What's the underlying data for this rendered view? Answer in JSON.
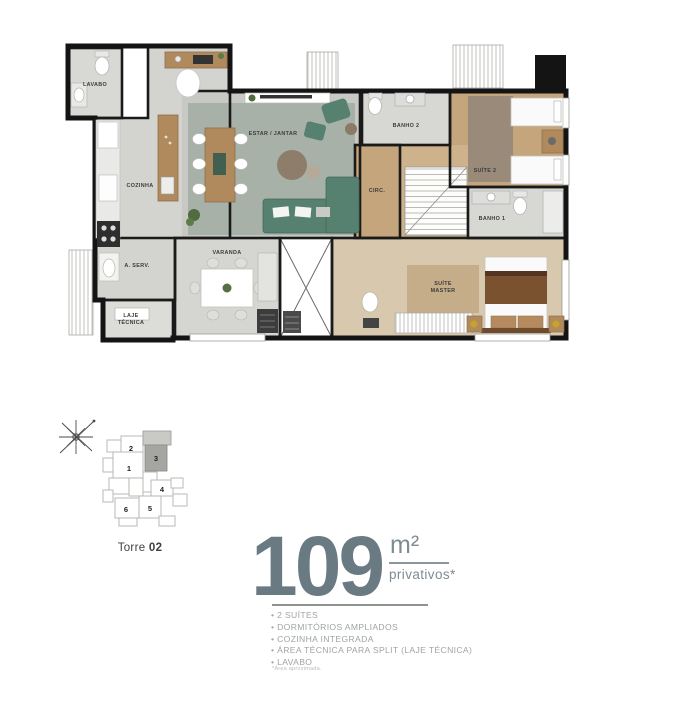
{
  "floor_plan": {
    "rooms": {
      "lavabo": "LAVABO",
      "cozinha": "COZINHA",
      "estar_jantar": "ESTAR / JANTAR",
      "varanda": "VARANDA",
      "area_servico": "A. SERV.",
      "laje_line1": "LAJE",
      "laje_line2": "TÉCNICA",
      "banho2": "BANHO 2",
      "suite2": "SUÍTE 2",
      "circ": "CIRC.",
      "banho1": "BANHO 1",
      "suite_master_line1": "SUÍTE",
      "suite_master_line2": "MASTER"
    },
    "colors": {
      "wall": "#1a1a1a",
      "tile_floor": "#d6d6d2",
      "wood_floor": "#c4a57c",
      "living_rug": "#a7b1a8",
      "sofa": "#56806f",
      "master_wood": "#d8c9ae"
    }
  },
  "key_plan": {
    "tower_label": "Torre",
    "tower_number": "02",
    "units": [
      "1",
      "2",
      "3",
      "4",
      "5",
      "6"
    ],
    "highlighted_unit": "3",
    "highlight_color": "#a5a5a1"
  },
  "info": {
    "area_value": "109",
    "area_unit": "m²",
    "area_qualifier": "privativos*",
    "features": [
      "2 SUÍTES",
      "DORMITÓRIOS AMPLIADOS",
      "COZINHA INTEGRADA",
      "ÁREA TÉCNICA PARA SPLIT (LAJE TÉCNICA)",
      "LAVABO"
    ],
    "footnote": "*Área aproximada.",
    "accent_color": "#697a83"
  }
}
